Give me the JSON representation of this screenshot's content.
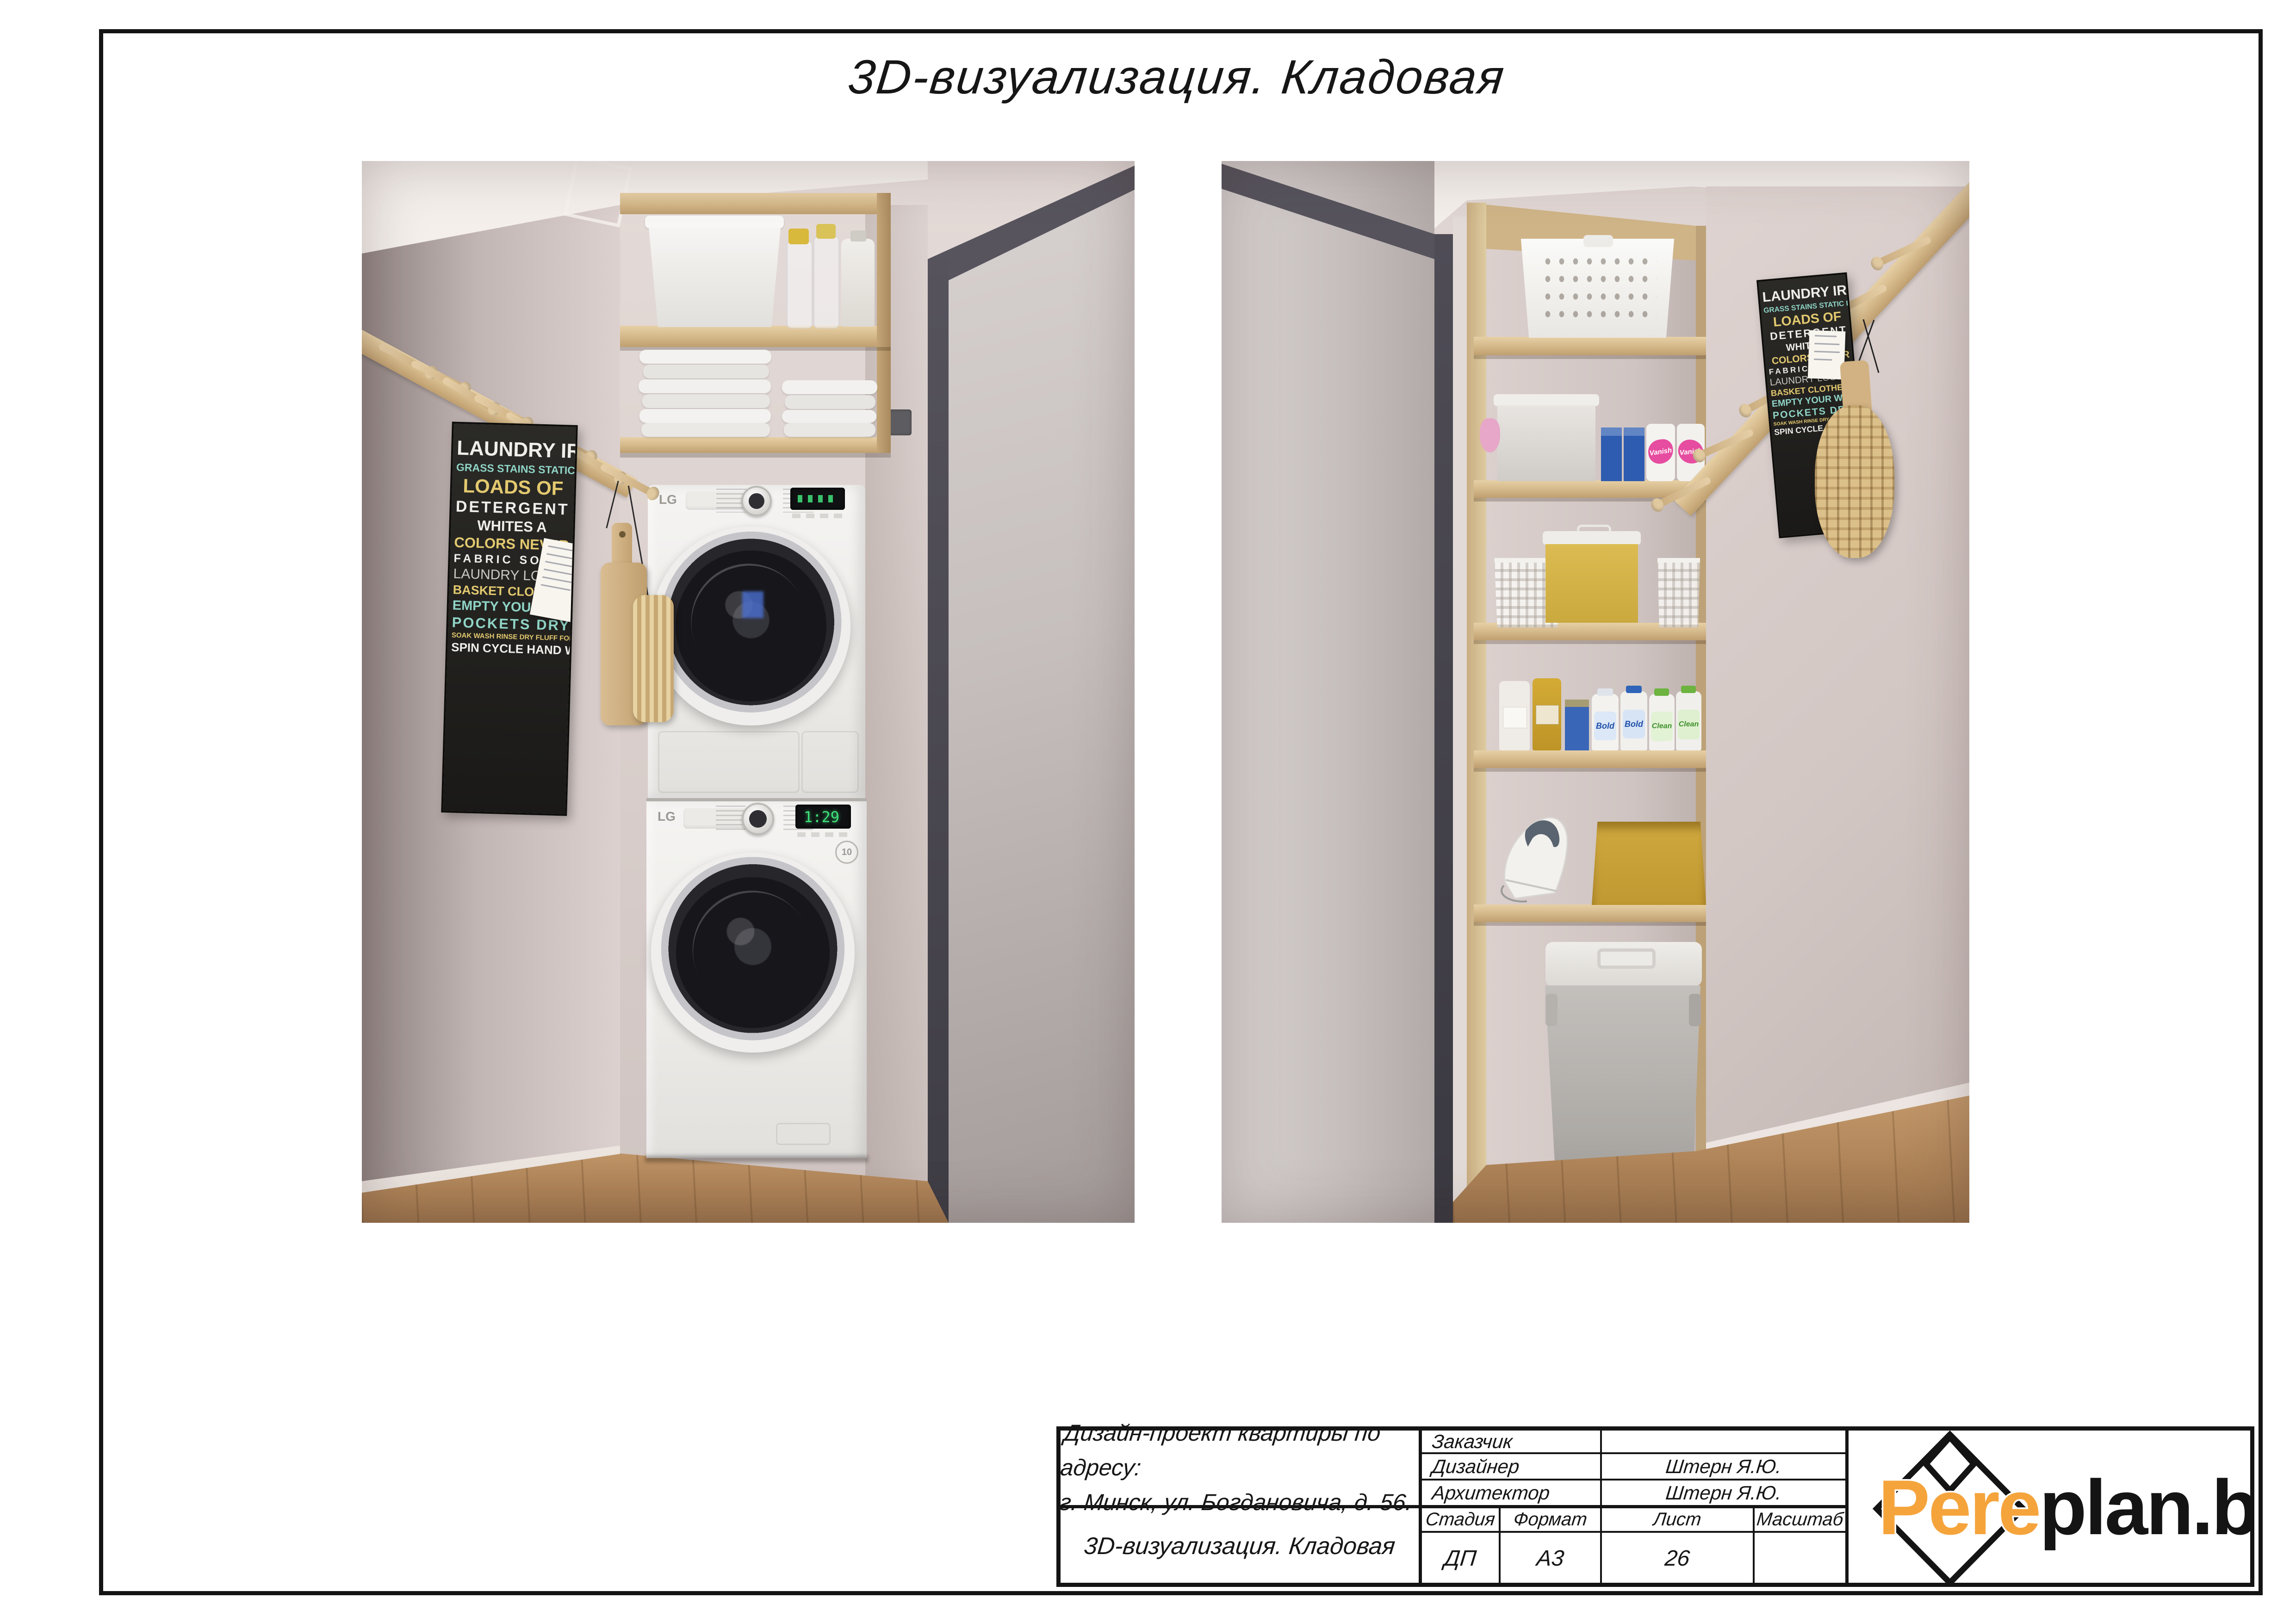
{
  "sheet": {
    "title": "3D-визуализация. Кладовая"
  },
  "title_block": {
    "project": {
      "line1": "Дизайн-проект квартиры по адресу:",
      "line2": "г. Минск, ул. Богдановича, д. 56."
    },
    "sheet_name": "3D-визуализация. Кладовая",
    "people": [
      {
        "label": "Заказчик",
        "value": ""
      },
      {
        "label": "Дизайнер",
        "value": "Штерн Я.Ю."
      },
      {
        "label": "Архитектор",
        "value": "Штерн Я.Ю."
      }
    ],
    "meta": [
      {
        "label": "Стадия",
        "value": "ДП"
      },
      {
        "label": "Формат",
        "value": "А3"
      },
      {
        "label": "Лист",
        "value": "26"
      },
      {
        "label": "Масштаб",
        "value": ""
      }
    ],
    "logo": {
      "word_accent": "Pere",
      "word_rest": "plan.by",
      "accent_color": "#f5a43c"
    }
  },
  "renders": {
    "brand": "LG",
    "washer_display": "1:29",
    "poster_lines": [
      "LAUNDRY IRON CLEAN",
      "GRASS STAINS STATIC LINT",
      "LOADS OF",
      "DETERGENT",
      "WHITES A",
      "COLORS NEVER",
      "FABRIC SOFTENER",
      "LAUNDRY LOST SOCKS",
      "BASKET CLOTHESPINS",
      "EMPTY YOUR WASHER",
      "POCKETS DRYER",
      "SOAK WASH RINSE DRY FLUFF FOLD",
      "SPIN CYCLE HAND WASH"
    ],
    "products": {
      "stain_remover": "Vanish",
      "detergent_bold": "Bold",
      "detergent_clean": "Clean"
    },
    "colors": {
      "wood": "#d3b788",
      "wall": "#d8cdcb",
      "door_frame": "#514e58",
      "vanish_pink": "#e64c9f",
      "bold_blue": "#2f64b8",
      "clean_green": "#6cb33f"
    }
  }
}
